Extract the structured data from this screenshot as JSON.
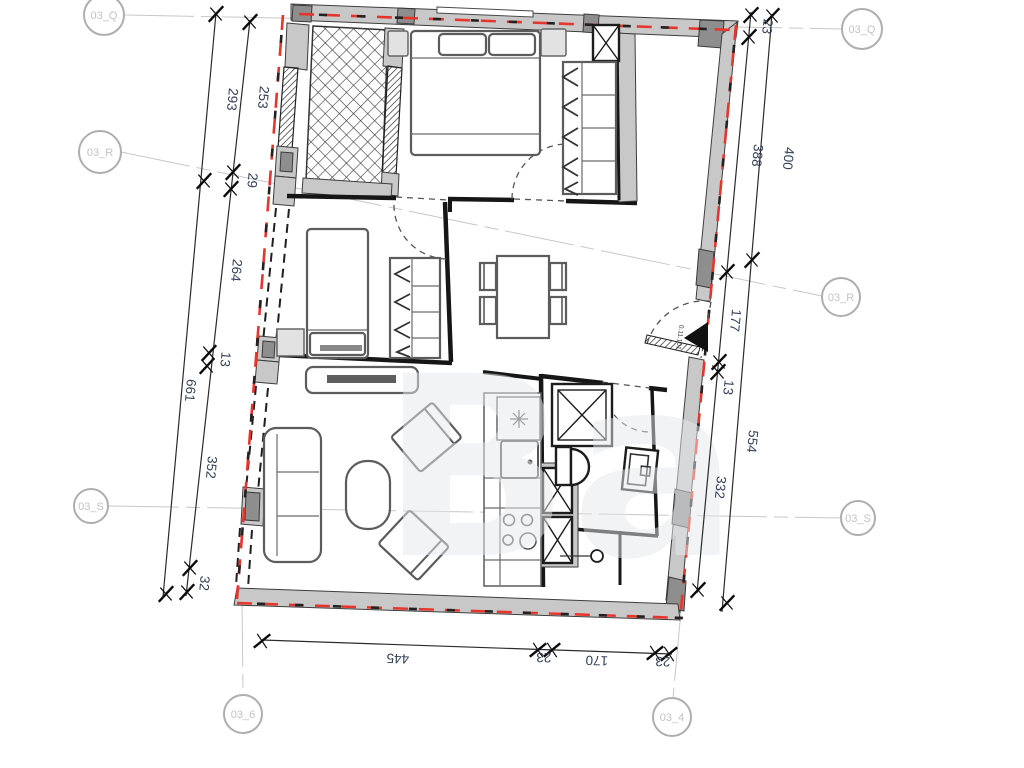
{
  "drawing": {
    "watermark": "Ba"
  },
  "grid_markers": {
    "q_left": "03_Q",
    "q_right": "03_Q",
    "r_left": "03_R",
    "r_right": "03_R",
    "s_left": "03_S",
    "s_right": "03_S",
    "bottom_left": "03_6",
    "bottom_right": "03_4"
  },
  "dimensions": {
    "left_outer": [
      "293",
      "661"
    ],
    "left_inner": [
      "253",
      "29",
      "264",
      "13",
      "352",
      "32"
    ],
    "right_inner": [
      "23",
      "388",
      "177",
      "13",
      "332"
    ],
    "right_outer": [
      "400",
      "554"
    ],
    "bottom": [
      "445",
      "23",
      "170",
      "23"
    ]
  },
  "entrance": {
    "label": "0.11.101"
  },
  "colors": {
    "red_dash": "#e8352b",
    "wall_fill": "#c8c8c8",
    "wall_dark": "#8e8e8e",
    "dim_text": "#35415a",
    "marker": "#c3c3c3"
  }
}
